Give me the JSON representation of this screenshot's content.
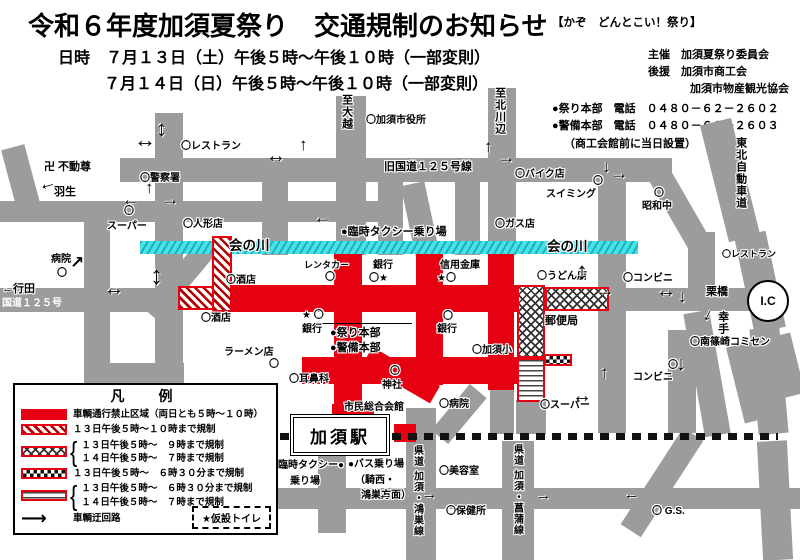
{
  "header": {
    "title": "令和６年度加須夏祭り　交通規制のお知らせ",
    "datetime1": "日時　７月１３日（土）午後５時～午後１０時（一部変則）",
    "datetime2": "７月１４日（日）午後５時～午後１０時（一部変則）",
    "slogan": "【かぞ　どんとこい！祭り】",
    "organizer": "主催　加須夏祭り委員会",
    "support1": "後援　加須市商工会",
    "support2": "加須市物産観光協会",
    "phone_festival": "●祭り本部　電話　０４８０－６２－２６０２",
    "phone_security": "●警備本部　電話　０４８０－６２－２６０３",
    "phone_note": "（商工会館前に当日設置）"
  },
  "station_label": "加須駅",
  "ic_label": "I.C",
  "map": {
    "labels": [
      {
        "t": "〇レストラン",
        "x": 181,
        "y": 141
      },
      {
        "t": "卍 不動尊",
        "x": 44,
        "y": 161,
        "c": "md"
      },
      {
        "t": "羽生",
        "x": 54,
        "y": 186,
        "c": "md"
      },
      {
        "t": "〇警察署",
        "x": 140,
        "y": 173
      },
      {
        "t": "〇",
        "x": 124,
        "y": 206
      },
      {
        "t": "スーパー",
        "x": 107,
        "y": 221
      },
      {
        "t": "〇人形店",
        "x": 183,
        "y": 219
      },
      {
        "t": "至大越",
        "x": 340,
        "y": 94,
        "c": "v md"
      },
      {
        "t": "〇加須市役所",
        "x": 366,
        "y": 115
      },
      {
        "t": "旧国道１２５号線",
        "x": 384,
        "y": 161,
        "c": "md"
      },
      {
        "t": "至北川辺",
        "x": 493,
        "y": 87,
        "c": "v md"
      },
      {
        "t": "〇バイク店",
        "x": 515,
        "y": 169
      },
      {
        "t": "〇",
        "x": 593,
        "y": 176
      },
      {
        "t": "スイミング",
        "x": 546,
        "y": 189
      },
      {
        "t": "〇",
        "x": 654,
        "y": 188
      },
      {
        "t": "昭和中",
        "x": 642,
        "y": 201
      },
      {
        "t": "〇ガス店",
        "x": 495,
        "y": 219
      },
      {
        "t": "会の川",
        "x": 229,
        "y": 238,
        "c": "lg"
      },
      {
        "t": "会の川",
        "x": 547,
        "y": 239,
        "c": "lg"
      },
      {
        "t": "●臨時タクシー乗り場",
        "x": 341,
        "y": 226,
        "c": "md"
      },
      {
        "t": "レンタカー",
        "x": 304,
        "y": 260,
        "c": "sm"
      },
      {
        "t": "〇",
        "x": 325,
        "y": 272
      },
      {
        "t": "銀行",
        "x": 373,
        "y": 260
      },
      {
        "t": "〇★",
        "x": 369,
        "y": 273
      },
      {
        "t": "信用金庫",
        "x": 440,
        "y": 260
      },
      {
        "t": "★〇",
        "x": 437,
        "y": 273
      },
      {
        "t": "〇うどん店",
        "x": 537,
        "y": 271
      },
      {
        "t": "〇コンビニ",
        "x": 623,
        "y": 273
      },
      {
        "t": "〇酒店",
        "x": 226,
        "y": 275
      },
      {
        "t": "〇酒店",
        "x": 201,
        "y": 313
      },
      {
        "t": "★ 〇",
        "x": 302,
        "y": 310
      },
      {
        "t": "銀行",
        "x": 302,
        "y": 324
      },
      {
        "t": "●祭り本部",
        "x": 330,
        "y": 327,
        "c": "md"
      },
      {
        "t": "●警備本部",
        "x": 330,
        "y": 342,
        "c": "md"
      },
      {
        "t": "〇",
        "x": 443,
        "y": 311
      },
      {
        "t": "銀行",
        "x": 437,
        "y": 324
      },
      {
        "t": "〇加須小",
        "x": 472,
        "y": 345
      },
      {
        "t": "郵便局",
        "x": 545,
        "y": 315,
        "c": "md"
      },
      {
        "t": "ラーメン店",
        "x": 224,
        "y": 347
      },
      {
        "t": "〇",
        "x": 269,
        "y": 359
      },
      {
        "t": "〇耳鼻科",
        "x": 289,
        "y": 374
      },
      {
        "t": "〇",
        "x": 390,
        "y": 366
      },
      {
        "t": "神社",
        "x": 382,
        "y": 380
      },
      {
        "t": "市民総合会館",
        "x": 344,
        "y": 402
      },
      {
        "t": "〇病院",
        "x": 439,
        "y": 399
      },
      {
        "t": "〇スーパー",
        "x": 540,
        "y": 400
      },
      {
        "t": "〇南篠崎コミセン",
        "x": 690,
        "y": 337
      },
      {
        "t": "〇",
        "x": 668,
        "y": 360
      },
      {
        "t": "コンビニ",
        "x": 633,
        "y": 372
      },
      {
        "t": "臨時タクシー●",
        "x": 278,
        "y": 460
      },
      {
        "t": "乗り場",
        "x": 290,
        "y": 476
      },
      {
        "t": "●バス乗り場",
        "x": 348,
        "y": 459
      },
      {
        "t": "（騎西・",
        "x": 355,
        "y": 475
      },
      {
        "t": "鴻巣方面）",
        "x": 361,
        "y": 490
      },
      {
        "t": "県道 加須・鴻巣線",
        "x": 411,
        "y": 445,
        "c": "v"
      },
      {
        "t": "〇美容室",
        "x": 439,
        "y": 466
      },
      {
        "t": "〇保健所",
        "x": 446,
        "y": 506
      },
      {
        "t": "県道 加須・菖蒲線",
        "x": 511,
        "y": 444,
        "c": "v"
      },
      {
        "t": "〇 G.S.",
        "x": 652,
        "y": 506
      },
      {
        "t": "←行田",
        "x": 2,
        "y": 283,
        "c": "md"
      },
      {
        "t": "国道１２５号",
        "x": 2,
        "y": 298,
        "c": "w"
      },
      {
        "t": "病院",
        "x": 51,
        "y": 254
      },
      {
        "t": "〇",
        "x": 57,
        "y": 268
      },
      {
        "t": "栗橋",
        "x": 706,
        "y": 286,
        "c": "md"
      },
      {
        "t": "幸手",
        "x": 716,
        "y": 311,
        "c": "v md"
      },
      {
        "t": "〇レストラン",
        "x": 722,
        "y": 249,
        "c": "sm"
      },
      {
        "t": "東北自動車道",
        "x": 734,
        "y": 137,
        "c": "v md"
      }
    ],
    "arrows": [
      {
        "g": "↔",
        "x": 134,
        "y": 129,
        "s": 22
      },
      {
        "g": "↕",
        "x": 156,
        "y": 118,
        "s": 22
      },
      {
        "g": "←",
        "x": 122,
        "y": 191,
        "s": 17
      },
      {
        "g": "↑",
        "x": 145,
        "y": 179,
        "s": 17
      },
      {
        "g": "→",
        "x": 162,
        "y": 191,
        "s": 17
      },
      {
        "g": "←",
        "x": 38,
        "y": 174,
        "s": 18,
        "r": -15
      },
      {
        "g": "↔",
        "x": 266,
        "y": 146,
        "s": 20
      },
      {
        "g": "↑",
        "x": 299,
        "y": 136,
        "s": 17
      },
      {
        "g": "↑",
        "x": 484,
        "y": 138,
        "s": 17
      },
      {
        "g": "→",
        "x": 498,
        "y": 149,
        "s": 17
      },
      {
        "g": "↓",
        "x": 602,
        "y": 158,
        "s": 17
      },
      {
        "g": "→",
        "x": 611,
        "y": 165,
        "s": 17
      },
      {
        "g": "←",
        "x": 314,
        "y": 209,
        "s": 17
      },
      {
        "g": "↗",
        "x": 70,
        "y": 254,
        "s": 17
      },
      {
        "g": "↔",
        "x": 104,
        "y": 279,
        "s": 20
      },
      {
        "g": "↕",
        "x": 150,
        "y": 262,
        "s": 26
      },
      {
        "g": "↕",
        "x": 576,
        "y": 260,
        "s": 24
      },
      {
        "g": "→",
        "x": 597,
        "y": 282,
        "s": 17
      },
      {
        "g": "↔",
        "x": 656,
        "y": 281,
        "s": 20
      },
      {
        "g": "↓",
        "x": 678,
        "y": 288,
        "s": 17
      },
      {
        "g": "↓",
        "x": 704,
        "y": 306,
        "s": 17,
        "r": 25
      },
      {
        "g": "↑",
        "x": 600,
        "y": 364,
        "s": 17
      },
      {
        "g": "↔",
        "x": 572,
        "y": 386,
        "s": 20
      },
      {
        "g": "←",
        "x": 378,
        "y": 487,
        "s": 15
      },
      {
        "g": "→",
        "x": 422,
        "y": 487,
        "s": 15
      },
      {
        "g": "→",
        "x": 536,
        "y": 488,
        "s": 15
      },
      {
        "g": "←",
        "x": 624,
        "y": 487,
        "s": 15
      },
      {
        "g": "↑",
        "x": 316,
        "y": 435,
        "s": 15
      },
      {
        "g": "↓",
        "x": 676,
        "y": 354,
        "s": 20
      }
    ]
  },
  "legend": {
    "title": "凡　例",
    "items": [
      {
        "pattern": "solid",
        "lines": [
          "車輌通行禁止区域（両日とも５時～１０時）"
        ]
      },
      {
        "pattern": "diag",
        "lines": [
          "１３日午後５時～１０時まで規制"
        ]
      },
      {
        "pattern": "cross",
        "lines": [
          "１３日午後５時～　９時まで規制",
          "１４日午後５時～　７時まで規制"
        ]
      },
      {
        "pattern": "check",
        "lines": [
          "１３日午後５時～　６時３０分まで規制"
        ]
      },
      {
        "pattern": "wave",
        "lines": [
          "１３日午後５時～　６時３０分まで規制",
          "１４日午後５時～　７時まで規制"
        ]
      }
    ],
    "detour": "車輌迂回路",
    "toilet": "★仮設トイレ"
  },
  "colors": {
    "road_gray": "#9c9c9c",
    "restricted_red": "#e50012",
    "river_cyan": "#45e3e6"
  }
}
